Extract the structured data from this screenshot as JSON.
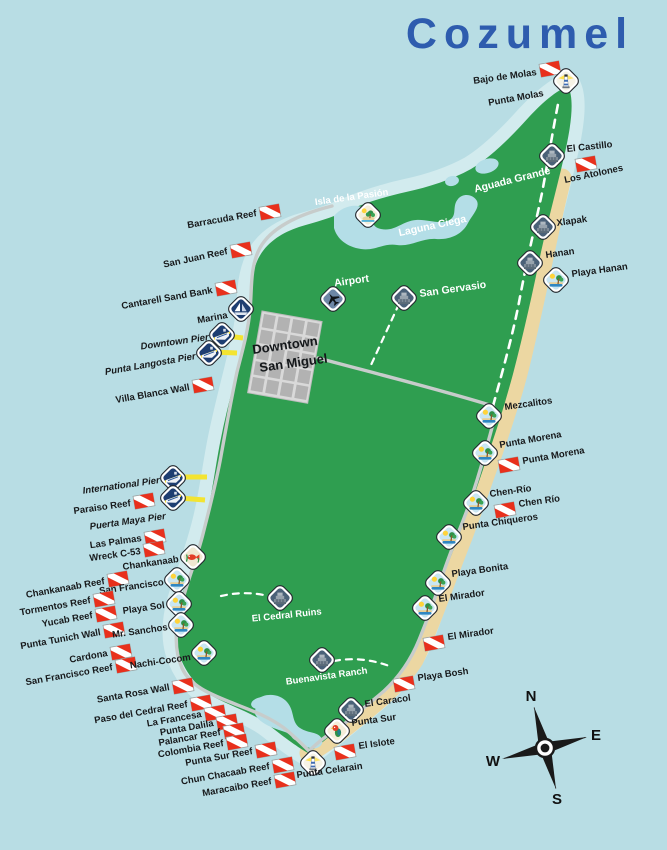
{
  "title": "Cozumel",
  "downtown": {
    "line1": "Downtown",
    "line2": "San Miguel"
  },
  "compass": {
    "n": "N",
    "e": "E",
    "s": "S",
    "w": "W"
  },
  "colors": {
    "ocean": "#b8dde4",
    "shore": "#d2ebee",
    "island": "#2f9e50",
    "sand": "#ecd7a2",
    "lagoon": "#b4dee7",
    "road": "#c7cccb",
    "road_dash": "#ffffff",
    "pier": "#f3e431",
    "flag": "#e8301c",
    "title": "#2e5cae",
    "label": "#17191b",
    "label_white": "#ffffff"
  },
  "icon_legend": {
    "dive": "diver-down-flag",
    "ruins": "mayan-ruins-icon",
    "beach": "beach-icon",
    "lighthouse": "lighthouse-icon",
    "boat": "marina-sailboat-icon",
    "ship": "cruise-pier-icon",
    "plane": "airport-icon",
    "island": "island-icon",
    "park": "snorkel-park-icon",
    "parrot": "eco-park-icon"
  },
  "markers": [
    {
      "label": "Bajo de Molas",
      "type": "dive",
      "ix": 550,
      "iy": 69,
      "lx": 537,
      "ly": 75,
      "rot": -8,
      "anchor": "end"
    },
    {
      "label": "Punta Molas",
      "type": "lighthouse",
      "ix": 566,
      "iy": 81,
      "lx": 544,
      "ly": 96,
      "rot": -10,
      "anchor": "end"
    },
    {
      "label": "El Castillo",
      "type": "ruins",
      "ix": 552,
      "iy": 156,
      "lx": 567,
      "ly": 152,
      "rot": -6,
      "anchor": "start"
    },
    {
      "label": "Los Atolones",
      "type": "dive",
      "ix": 586,
      "iy": 164,
      "lx": 565,
      "ly": 183,
      "rot": -12,
      "anchor": "start"
    },
    {
      "label": "Aguada Grande",
      "type": "none",
      "lx": 513,
      "ly": 183,
      "rot": -14,
      "anchor": "middle",
      "cls": "white big"
    },
    {
      "label": "Xlapak",
      "type": "ruins",
      "ix": 543,
      "iy": 227,
      "lx": 557,
      "ly": 226,
      "rot": -8,
      "anchor": "start"
    },
    {
      "label": "Hanan",
      "type": "ruins",
      "ix": 530,
      "iy": 263,
      "lx": 546,
      "ly": 258,
      "rot": -8,
      "anchor": "start"
    },
    {
      "label": "Playa Hanan",
      "type": "beach",
      "ix": 556,
      "iy": 280,
      "lx": 572,
      "ly": 277,
      "rot": -8,
      "anchor": "start"
    },
    {
      "label": "Isla de la Pasión",
      "type": "island",
      "ix": 368,
      "iy": 215,
      "lx": 352,
      "ly": 200,
      "rot": -8,
      "anchor": "middle",
      "cls": "white"
    },
    {
      "label": "Laguna Ciega",
      "type": "none",
      "lx": 433,
      "ly": 229,
      "rot": -12,
      "anchor": "middle",
      "cls": "white big"
    },
    {
      "label": "Barracuda Reef",
      "type": "dive",
      "ix": 270,
      "iy": 212,
      "lx": 257,
      "ly": 216,
      "rot": -10,
      "anchor": "end"
    },
    {
      "label": "San Juan Reef",
      "type": "dive",
      "ix": 241,
      "iy": 250,
      "lx": 228,
      "ly": 254,
      "rot": -12,
      "anchor": "end"
    },
    {
      "label": "Cantarell Sand Bank",
      "type": "dive",
      "ix": 226,
      "iy": 288,
      "lx": 213,
      "ly": 293,
      "rot": -10,
      "anchor": "end"
    },
    {
      "label": "Marina",
      "type": "boat",
      "ix": 241,
      "iy": 309,
      "lx": 228,
      "ly": 318,
      "rot": -10,
      "anchor": "end"
    },
    {
      "label": "Downtown Pier",
      "type": "ship",
      "ix": 222,
      "iy": 335,
      "lx": 209,
      "ly": 340,
      "rot": -8,
      "anchor": "end",
      "cls": "pier-lbl"
    },
    {
      "label": "Punta Langosta Pier",
      "type": "ship",
      "ix": 209,
      "iy": 353,
      "lx": 196,
      "ly": 359,
      "rot": -10,
      "anchor": "end",
      "cls": "pier-lbl"
    },
    {
      "label": "Villa Blanca Wall",
      "type": "dive",
      "ix": 203,
      "iy": 385,
      "lx": 190,
      "ly": 390,
      "rot": -10,
      "anchor": "end"
    },
    {
      "label": "Airport",
      "type": "plane",
      "ix": 333,
      "iy": 299,
      "lx": 352,
      "ly": 284,
      "rot": -8,
      "anchor": "middle",
      "cls": "white big"
    },
    {
      "label": "San Gervasio",
      "type": "ruins",
      "ix": 404,
      "iy": 298,
      "lx": 420,
      "ly": 297,
      "rot": -8,
      "anchor": "start",
      "cls": "white big"
    },
    {
      "label": "International Pier",
      "type": "ship",
      "ix": 173,
      "iy": 478,
      "lx": 160,
      "ly": 483,
      "rot": -8,
      "anchor": "end",
      "cls": "pier-lbl"
    },
    {
      "label": "Paraiso Reef",
      "type": "dive",
      "ix": 144,
      "iy": 501,
      "lx": 131,
      "ly": 506,
      "rot": -8,
      "anchor": "end"
    },
    {
      "label": "Puerta Maya Pier",
      "type": "ship",
      "ix": 173,
      "iy": 498,
      "lx": 166,
      "ly": 519,
      "rot": -8,
      "anchor": "end",
      "cls": "pier-lbl"
    },
    {
      "label": "Las Palmas",
      "type": "dive",
      "ix": 155,
      "iy": 537,
      "lx": 142,
      "ly": 541,
      "rot": -8,
      "anchor": "end"
    },
    {
      "label": "Wreck C-53",
      "type": "dive",
      "ix": 154,
      "iy": 549,
      "lx": 141,
      "ly": 554,
      "rot": -8,
      "anchor": "end"
    },
    {
      "label": "Chankanaab",
      "type": "park",
      "ix": 193,
      "iy": 557,
      "lx": 179,
      "ly": 562,
      "rot": -8,
      "anchor": "end"
    },
    {
      "label": "Chankanaab Reef",
      "type": "dive",
      "ix": 118,
      "iy": 579,
      "lx": 105,
      "ly": 584,
      "rot": -10,
      "anchor": "end"
    },
    {
      "label": "San Francisco",
      "type": "beach",
      "ix": 177,
      "iy": 580,
      "lx": 164,
      "ly": 585,
      "rot": -8,
      "anchor": "end"
    },
    {
      "label": "Tormentos Reef",
      "type": "dive",
      "ix": 104,
      "iy": 599,
      "lx": 91,
      "ly": 603,
      "rot": -10,
      "anchor": "end"
    },
    {
      "label": "Playa Sol",
      "type": "beach",
      "ix": 179,
      "iy": 604,
      "lx": 165,
      "ly": 608,
      "rot": -8,
      "anchor": "end"
    },
    {
      "label": "Yucab Reef",
      "type": "dive",
      "ix": 106,
      "iy": 614,
      "lx": 93,
      "ly": 618,
      "rot": -10,
      "anchor": "end"
    },
    {
      "label": "Punta Tunich Wall",
      "type": "dive",
      "ix": 114,
      "iy": 630,
      "lx": 101,
      "ly": 635,
      "rot": -10,
      "anchor": "end"
    },
    {
      "label": "Mr. Sanchos",
      "type": "beach",
      "ix": 181,
      "iy": 625,
      "lx": 168,
      "ly": 630,
      "rot": -8,
      "anchor": "end"
    },
    {
      "label": "Cardona",
      "type": "dive",
      "ix": 121,
      "iy": 652,
      "lx": 108,
      "ly": 656,
      "rot": -10,
      "anchor": "end"
    },
    {
      "label": "San Francisco Reef",
      "type": "dive",
      "ix": 126,
      "iy": 665,
      "lx": 113,
      "ly": 670,
      "rot": -10,
      "anchor": "end"
    },
    {
      "label": "Nachi-Cocom",
      "type": "beach",
      "ix": 204,
      "iy": 653,
      "lx": 191,
      "ly": 660,
      "rot": -8,
      "anchor": "end"
    },
    {
      "label": "Santa Rosa Wall",
      "type": "dive",
      "ix": 183,
      "iy": 686,
      "lx": 170,
      "ly": 690,
      "rot": -10,
      "anchor": "end"
    },
    {
      "label": "Paso del Cedral Reef",
      "type": "dive",
      "ix": 201,
      "iy": 703,
      "lx": 188,
      "ly": 707,
      "rot": -10,
      "anchor": "end"
    },
    {
      "label": "La Francesa",
      "type": "dive",
      "ix": 215,
      "iy": 713,
      "lx": 202,
      "ly": 717,
      "rot": -10,
      "anchor": "end"
    },
    {
      "label": "Punta Dalila",
      "type": "dive",
      "ix": 227,
      "iy": 722,
      "lx": 214,
      "ly": 726,
      "rot": -10,
      "anchor": "end"
    },
    {
      "label": "Palancar Reef",
      "type": "dive",
      "ix": 234,
      "iy": 731,
      "lx": 221,
      "ly": 735,
      "rot": -10,
      "anchor": "end"
    },
    {
      "label": "Colombia Reef",
      "type": "dive",
      "ix": 237,
      "iy": 742,
      "lx": 224,
      "ly": 746,
      "rot": -10,
      "anchor": "end"
    },
    {
      "label": "Punta Sur Reef",
      "type": "dive",
      "ix": 266,
      "iy": 750,
      "lx": 253,
      "ly": 754,
      "rot": -10,
      "anchor": "end"
    },
    {
      "label": "Chun Chacaab Reef",
      "type": "dive",
      "ix": 283,
      "iy": 765,
      "lx": 270,
      "ly": 769,
      "rot": -10,
      "anchor": "end"
    },
    {
      "label": "Maracaibo Reef",
      "type": "dive",
      "ix": 285,
      "iy": 780,
      "lx": 272,
      "ly": 784,
      "rot": -10,
      "anchor": "end"
    },
    {
      "label": "El Cedral Ruins",
      "type": "ruins",
      "ix": 280,
      "iy": 598,
      "lx": 287,
      "ly": 618,
      "rot": -6,
      "anchor": "middle",
      "cls": "white"
    },
    {
      "label": "Buenavista Ranch",
      "type": "ruins",
      "ix": 322,
      "iy": 660,
      "lx": 327,
      "ly": 679,
      "rot": -8,
      "anchor": "middle",
      "cls": "white"
    },
    {
      "label": "Mezcalitos",
      "type": "beach",
      "ix": 489,
      "iy": 416,
      "lx": 505,
      "ly": 410,
      "rot": -8,
      "anchor": "start"
    },
    {
      "label": "Punta Morena",
      "type": "beach",
      "ix": 485,
      "iy": 453,
      "lx": 500,
      "ly": 448,
      "rot": -10,
      "anchor": "start"
    },
    {
      "label": "Punta Morena",
      "type": "dive",
      "ix": 509,
      "iy": 465,
      "lx": 523,
      "ly": 464,
      "rot": -10,
      "anchor": "start"
    },
    {
      "label": "Chen-Río",
      "type": "beach",
      "ix": 476,
      "iy": 503,
      "lx": 490,
      "ly": 497,
      "rot": -8,
      "anchor": "start"
    },
    {
      "label": "Chen Río",
      "type": "dive",
      "ix": 505,
      "iy": 510,
      "lx": 519,
      "ly": 507,
      "rot": -8,
      "anchor": "start"
    },
    {
      "label": "Punta Chiqueros",
      "type": "beach",
      "ix": 449,
      "iy": 537,
      "lx": 463,
      "ly": 530,
      "rot": -8,
      "anchor": "start"
    },
    {
      "label": "Playa Bonita",
      "type": "beach",
      "ix": 438,
      "iy": 583,
      "lx": 452,
      "ly": 577,
      "rot": -8,
      "anchor": "start"
    },
    {
      "label": "El Mirador",
      "type": "beach",
      "ix": 425,
      "iy": 608,
      "lx": 439,
      "ly": 602,
      "rot": -8,
      "anchor": "start"
    },
    {
      "label": "El Mirador",
      "type": "dive",
      "ix": 434,
      "iy": 643,
      "lx": 448,
      "ly": 640,
      "rot": -8,
      "anchor": "start"
    },
    {
      "label": "Playa Bosh",
      "type": "dive",
      "ix": 404,
      "iy": 684,
      "lx": 418,
      "ly": 681,
      "rot": -8,
      "anchor": "start"
    },
    {
      "label": "El Caracol",
      "type": "ruins",
      "ix": 351,
      "iy": 710,
      "lx": 365,
      "ly": 707,
      "rot": -8,
      "anchor": "start"
    },
    {
      "label": "Punta Sur",
      "type": "parrot",
      "ix": 337,
      "iy": 731,
      "lx": 352,
      "ly": 726,
      "rot": -8,
      "anchor": "start"
    },
    {
      "label": "El Islote",
      "type": "dive",
      "ix": 345,
      "iy": 752,
      "lx": 359,
      "ly": 749,
      "rot": -8,
      "anchor": "start"
    },
    {
      "label": "Punta Celarain",
      "type": "lighthouse",
      "ix": 313,
      "iy": 763,
      "lx": 297,
      "ly": 778,
      "rot": -8,
      "anchor": "start"
    }
  ]
}
